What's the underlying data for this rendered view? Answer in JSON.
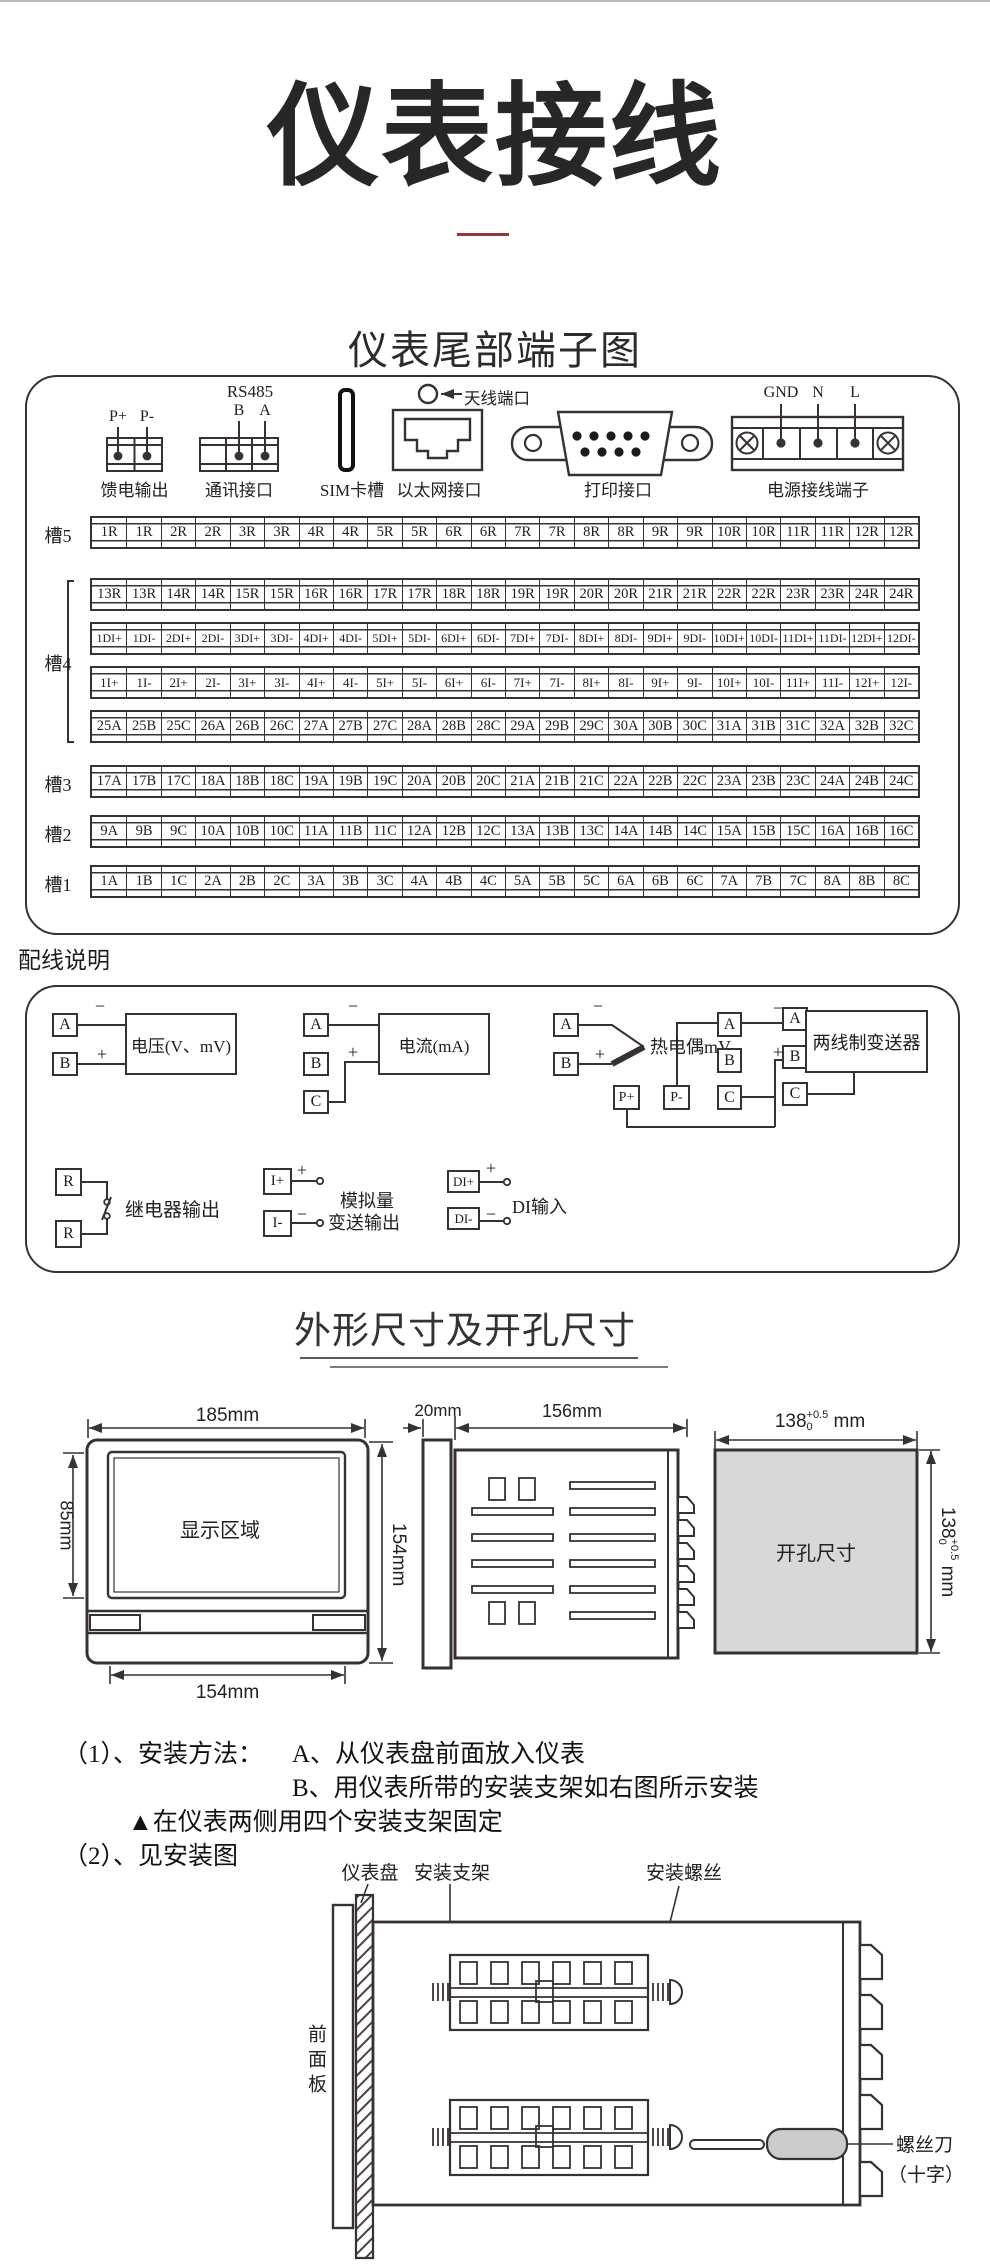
{
  "page": {
    "title": "仪表接线",
    "terminal_section_heading": "仪表尾部端子图",
    "wiring_section_label": "配线说明",
    "dimensions_heading": "外形尺寸及开孔尺寸"
  },
  "rear_connectors": {
    "feed_output": {
      "pins": [
        "P+",
        "P-"
      ],
      "label": "馈电输出"
    },
    "comm": {
      "title": "RS485",
      "pins": [
        "B",
        "A"
      ],
      "label": "通讯接口"
    },
    "sim": {
      "label": "SIM卡槽"
    },
    "ethernet": {
      "label": "以太网接口"
    },
    "antenna": {
      "label": "天线端口"
    },
    "printer": {
      "label": "打印接口"
    },
    "power": {
      "pins": [
        "GND",
        "N",
        "L"
      ],
      "label": "电源接线端子"
    }
  },
  "terminal_grid": {
    "slot_labels": [
      "槽5",
      "槽4",
      "槽3",
      "槽2",
      "槽1"
    ],
    "rows": [
      [
        "1R",
        "1R",
        "2R",
        "2R",
        "3R",
        "3R",
        "4R",
        "4R",
        "5R",
        "5R",
        "6R",
        "6R",
        "7R",
        "7R",
        "8R",
        "8R",
        "9R",
        "9R",
        "10R",
        "10R",
        "11R",
        "11R",
        "12R",
        "12R"
      ],
      [
        "13R",
        "13R",
        "14R",
        "14R",
        "15R",
        "15R",
        "16R",
        "16R",
        "17R",
        "17R",
        "18R",
        "18R",
        "19R",
        "19R",
        "20R",
        "20R",
        "21R",
        "21R",
        "22R",
        "22R",
        "23R",
        "23R",
        "24R",
        "24R"
      ],
      [
        "1DI+",
        "1DI-",
        "2DI+",
        "2DI-",
        "3DI+",
        "3DI-",
        "4DI+",
        "4DI-",
        "5DI+",
        "5DI-",
        "6DI+",
        "6DI-",
        "7DI+",
        "7DI-",
        "8DI+",
        "8DI-",
        "9DI+",
        "9DI-",
        "10DI+",
        "10DI-",
        "11DI+",
        "11DI-",
        "12DI+",
        "12DI-"
      ],
      [
        "1I+",
        "1I-",
        "2I+",
        "2I-",
        "3I+",
        "3I-",
        "4I+",
        "4I-",
        "5I+",
        "5I-",
        "6I+",
        "6I-",
        "7I+",
        "7I-",
        "8I+",
        "8I-",
        "9I+",
        "9I-",
        "10I+",
        "10I-",
        "11I+",
        "11I-",
        "12I+",
        "12I-"
      ],
      [
        "25A",
        "25B",
        "25C",
        "26A",
        "26B",
        "26C",
        "27A",
        "27B",
        "27C",
        "28A",
        "28B",
        "28C",
        "29A",
        "29B",
        "29C",
        "30A",
        "30B",
        "30C",
        "31A",
        "31B",
        "31C",
        "32A",
        "32B",
        "32C"
      ],
      [
        "17A",
        "17B",
        "17C",
        "18A",
        "18B",
        "18C",
        "19A",
        "19B",
        "19C",
        "20A",
        "20B",
        "20C",
        "21A",
        "21B",
        "21C",
        "22A",
        "22B",
        "22C",
        "23A",
        "23B",
        "23C",
        "24A",
        "24B",
        "24C"
      ],
      [
        "9A",
        "9B",
        "9C",
        "10A",
        "10B",
        "10C",
        "11A",
        "11B",
        "11C",
        "12A",
        "12B",
        "12C",
        "13A",
        "13B",
        "13C",
        "14A",
        "14B",
        "14C",
        "15A",
        "15B",
        "15C",
        "16A",
        "16B",
        "16C"
      ],
      [
        "1A",
        "1B",
        "1C",
        "2A",
        "2B",
        "2C",
        "3A",
        "3B",
        "3C",
        "4A",
        "4B",
        "4C",
        "5A",
        "5B",
        "5C",
        "6A",
        "6B",
        "6C",
        "7A",
        "7B",
        "7C",
        "8A",
        "8B",
        "8C"
      ]
    ]
  },
  "wiring": {
    "voltage": {
      "terminals": [
        "A",
        "B"
      ],
      "minus": "−",
      "plus": "+",
      "label": "电压(V、mV)"
    },
    "current": {
      "terminals": [
        "A",
        "B",
        "C"
      ],
      "minus": "−",
      "plus": "+",
      "label": "电流(mA)"
    },
    "thermocouple": {
      "terminals": [
        "A",
        "B"
      ],
      "minus": "−",
      "plus": "+",
      "label": "热电偶mV"
    },
    "rtd": {
      "terminals": [
        "A",
        "B",
        "C"
      ],
      "label": "热电阻"
    },
    "relay": {
      "terminals": [
        "R",
        "R"
      ],
      "label": "继电器输出"
    },
    "analog_out": {
      "terminals": [
        "I+",
        "I-"
      ],
      "plus": "+",
      "minus": "−",
      "label_line1": "模拟量",
      "label_line2": "变送输出"
    },
    "di": {
      "terminals": [
        "DI+",
        "DI-"
      ],
      "plus": "+",
      "minus": "−",
      "label": "DI输入"
    },
    "transmitter": {
      "terminals": [
        "A",
        "B",
        "C"
      ],
      "power_pins": [
        "P+",
        "P-"
      ],
      "minus": "−",
      "plus": "+",
      "label": "两线制变送器"
    }
  },
  "dimensions": {
    "front": {
      "top": "185mm",
      "left": "85mm",
      "screen": "显示区域",
      "right": "154mm",
      "bottom": "154mm"
    },
    "side": {
      "bezel": "20mm",
      "depth": "156mm"
    },
    "cutout": {
      "value": "138",
      "tol_up": "+0.5",
      "tol_dn": "0",
      "unit": "mm",
      "label": "开孔尺寸"
    }
  },
  "install": {
    "line1_left": "（1）、安装方法：",
    "line1_right": "A、从仪表盘前面放入仪表",
    "line2": "B、用仪表所带的安装支架如右图所示安装",
    "line3": "▲在仪表两侧用四个安装支架固定",
    "line4": "（2）、见安装图"
  },
  "mounting": {
    "panel_label": "仪表盘",
    "bracket_label": "安装支架",
    "screw_label": "安装螺丝",
    "front_panel_label": "前面板",
    "screwdriver_label_line1": "螺丝刀",
    "screwdriver_label_line2": "（十字）"
  },
  "colors": {
    "accent_red": "#8e3a3d",
    "line": "#37322f",
    "cutout_fill": "#d8d8d8",
    "handle_fill": "#cbcbcb"
  }
}
